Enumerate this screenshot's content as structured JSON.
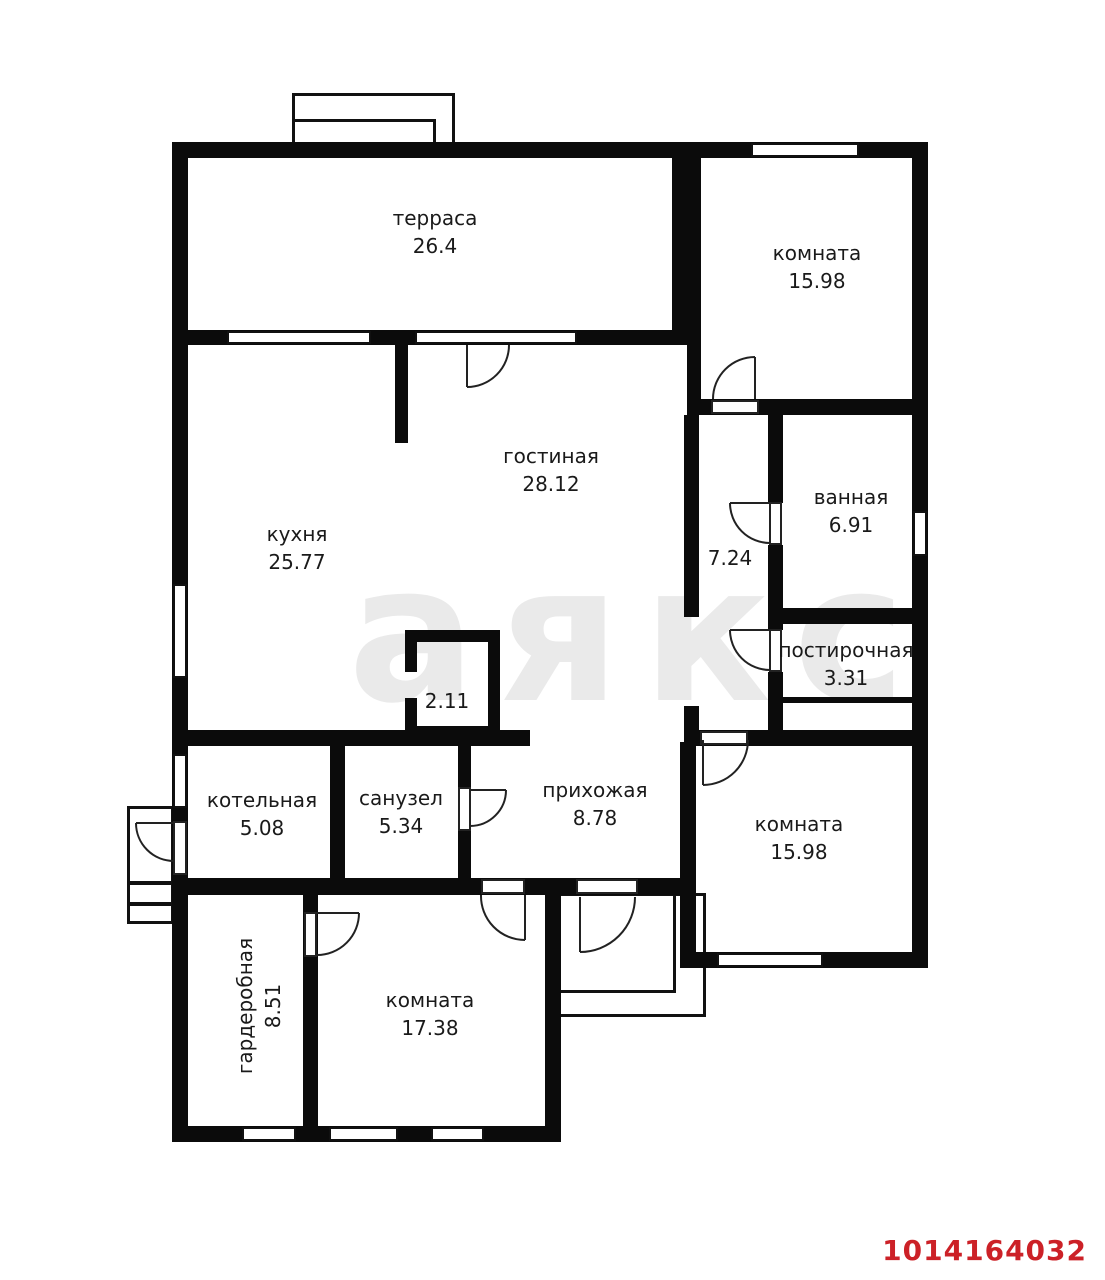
{
  "plan": {
    "watermark": "аякс",
    "listing_id": "1014164032",
    "colors": {
      "wall": "#0b0b0b",
      "listing_id_red": "#cc2127",
      "watermark_gray": "#eaeaea"
    },
    "rooms": [
      {
        "name": "терраса",
        "area": "26.4"
      },
      {
        "name": "комната",
        "area": "15.98"
      },
      {
        "name": "гостиная",
        "area": "28.12"
      },
      {
        "name": "кухня",
        "area": "25.77"
      },
      {
        "name": "ванная",
        "area": "6.91"
      },
      {
        "name": "",
        "area": "7.24"
      },
      {
        "name": "постирочная",
        "area": "3.31"
      },
      {
        "name": "",
        "area": "2.11"
      },
      {
        "name": "котельная",
        "area": "5.08"
      },
      {
        "name": "санузел",
        "area": "5.34"
      },
      {
        "name": "прихожая",
        "area": "8.78"
      },
      {
        "name": "комната",
        "area": "15.98"
      },
      {
        "name": "гардеробная",
        "area": "8.51"
      },
      {
        "name": "комната",
        "area": "17.38"
      }
    ]
  }
}
